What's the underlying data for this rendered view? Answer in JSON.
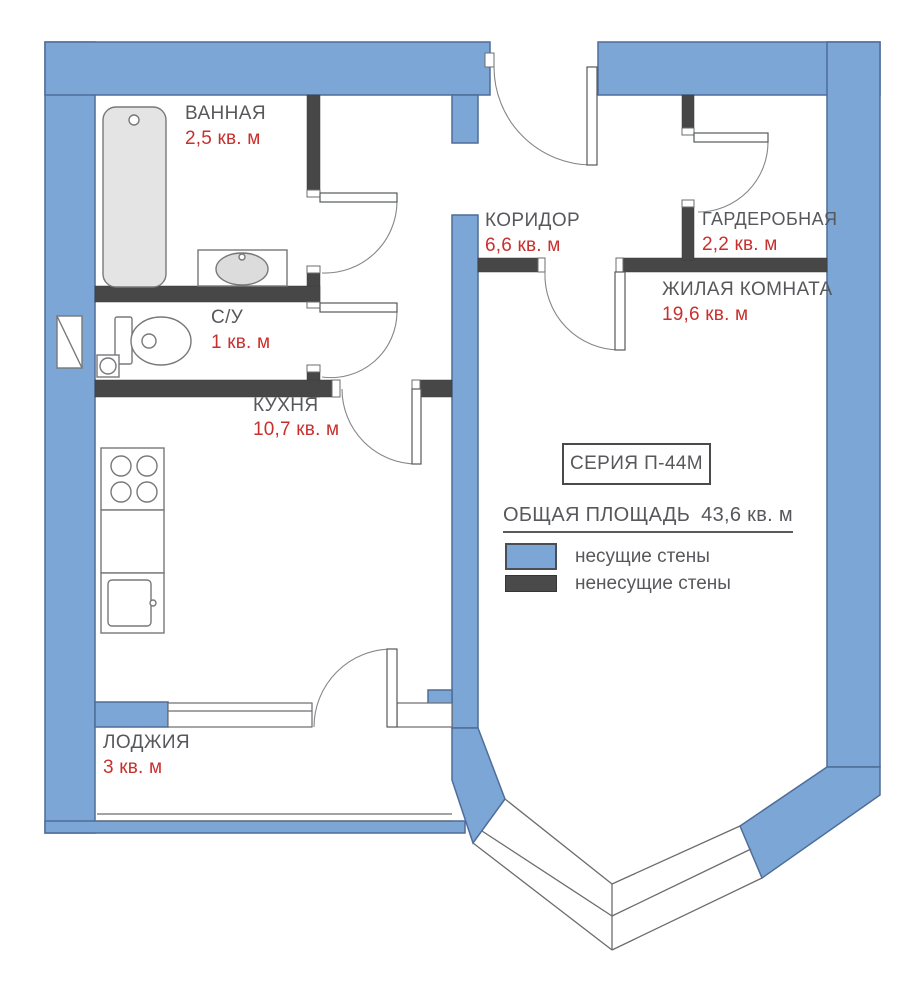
{
  "rooms": [
    {
      "id": "bathroom",
      "name": "ВАННАЯ",
      "area": "2,5 кв. м"
    },
    {
      "id": "toilet",
      "name": "С/У",
      "area": "1 кв. м"
    },
    {
      "id": "kitchen",
      "name": "КУХНЯ",
      "area": "10,7 кв. м"
    },
    {
      "id": "corridor",
      "name": "КОРИДОР",
      "area": "6,6 кв. м"
    },
    {
      "id": "wardrobe",
      "name": "ГАРДЕРОБНАЯ",
      "area": "2,2 кв. м"
    },
    {
      "id": "living_room",
      "name": "ЖИЛАЯ КОМНАТА",
      "area": "19,6 кв. м"
    },
    {
      "id": "loggia",
      "name": "ЛОДЖИЯ",
      "area": "3 кв. м"
    }
  ],
  "series_box": {
    "label": "СЕРИЯ П-44М"
  },
  "total_area": {
    "label": "ОБЩАЯ ПЛОЩАДЬ",
    "value": "43,6 кв. м"
  },
  "legend": {
    "items": [
      {
        "label": "несущие стены",
        "color": "#7ba6d6"
      },
      {
        "label": "ненесущие стены",
        "color": "#4a4a4a"
      }
    ]
  },
  "colors": {
    "load_bearing_wall": "#7ba6d6",
    "wall_outline": "#4f6d98",
    "partition_wall": "#474747",
    "area_text": "#c8302e",
    "label_text": "#57585b"
  }
}
